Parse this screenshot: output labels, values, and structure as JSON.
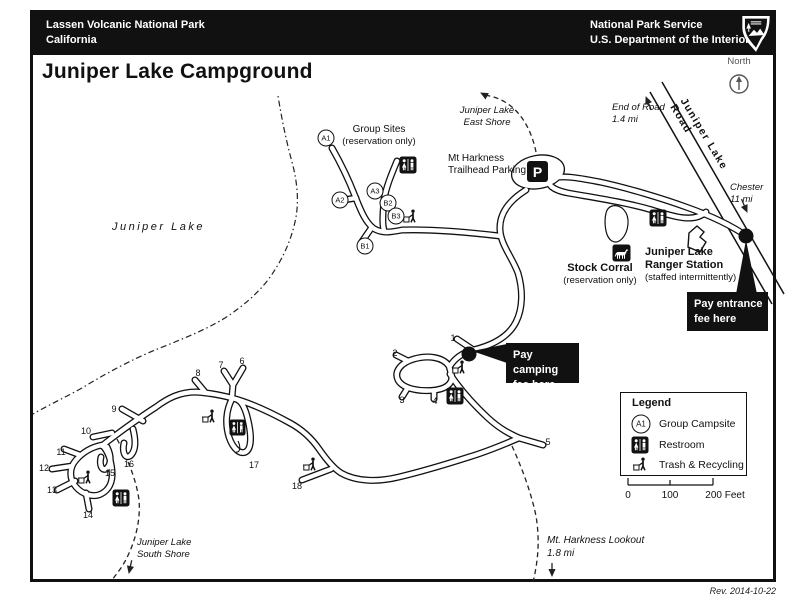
{
  "header": {
    "park": "Lassen Volcanic National Park",
    "state": "California",
    "agency": "National Park Service",
    "department": "U.S. Department of the Interior"
  },
  "title": "Juniper Lake Campground",
  "north_label": "North",
  "map": {
    "lake_label": "Juniper Lake",
    "road_label": "Juniper Lake Road",
    "end_of_road_l1": "End of Road",
    "end_of_road_l2": "1.4 mi",
    "chester_l1": "Chester",
    "chester_l2": "11 mi",
    "east_shore_l1": "Juniper Lake",
    "east_shore_l2": "East Shore",
    "trailhead_l1": "Mt Harkness",
    "trailhead_l2": "Trailhead Parking",
    "group_sites_l1": "Group Sites",
    "group_sites_l2": "(reservation only)",
    "stock_corral": "Stock Corral",
    "stock_corral_sub": "(reservation only)",
    "ranger_l1": "Juniper Lake",
    "ranger_l2": "Ranger Station",
    "ranger_sub": "(staffed intermittently)",
    "pay_entrance_l1": "Pay entrance",
    "pay_entrance_l2": "fee here",
    "pay_camping_l1": "Pay camping",
    "pay_camping_l2": "fee here",
    "south_shore_l1": "Juniper Lake",
    "south_shore_l2": "South Shore",
    "lookout_l1": "Mt. Harkness Lookout",
    "lookout_l2": "1.8 mi",
    "parking_symbol": "P",
    "group_labels": [
      "A1",
      "A2",
      "A3",
      "B1",
      "B2",
      "B3"
    ],
    "site_numbers": [
      "1",
      "2",
      "3",
      "4",
      "5",
      "6",
      "7",
      "8",
      "9",
      "10",
      "11",
      "12",
      "13",
      "14",
      "15",
      "16",
      "17",
      "18"
    ]
  },
  "legend": {
    "title": "Legend",
    "items": [
      {
        "icon": "group-campsite-symbol",
        "symbol": "A1",
        "label": "Group Campsite"
      },
      {
        "icon": "restroom-icon",
        "label": "Restroom"
      },
      {
        "icon": "trash-recycling-icon",
        "label": "Trash & Recycling"
      }
    ],
    "scale": {
      "start": "0",
      "mid": "100",
      "end": "200 Feet"
    }
  },
  "footer": {
    "revision": "Rev. 2014-10-22"
  },
  "colors": {
    "ink": "#111111",
    "paper": "#ffffff"
  }
}
